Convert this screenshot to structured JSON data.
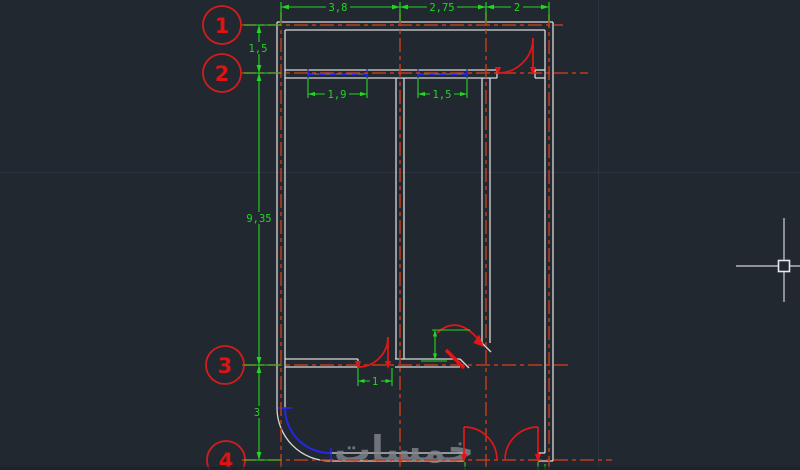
{
  "app": {
    "name": "cad-drawing-viewport",
    "description": "AutoCAD-style dark model space showing a dimensioned floor plan"
  },
  "drawing": {
    "watermark": "خمسات",
    "bubbles": [
      {
        "label": "1"
      },
      {
        "label": "2"
      },
      {
        "label": "3"
      },
      {
        "label": "4"
      }
    ],
    "dims": {
      "top": [
        "3,8",
        "2,75",
        "2"
      ],
      "left": [
        "1,5",
        "9,35",
        "3"
      ],
      "window1": "1,9",
      "window2": "1,5",
      "door": "1"
    },
    "colors": {
      "background": "#212830",
      "axis_red": "#c13a1d",
      "entity_red": "#e11717",
      "bubble_red": "#d21d1d",
      "dim_green": "#23d622",
      "wall_gray": "#d9d9d9",
      "window_blue": "#2726e8",
      "crosshair": "#ced3d8",
      "watermark_gray": "#82878d"
    }
  }
}
